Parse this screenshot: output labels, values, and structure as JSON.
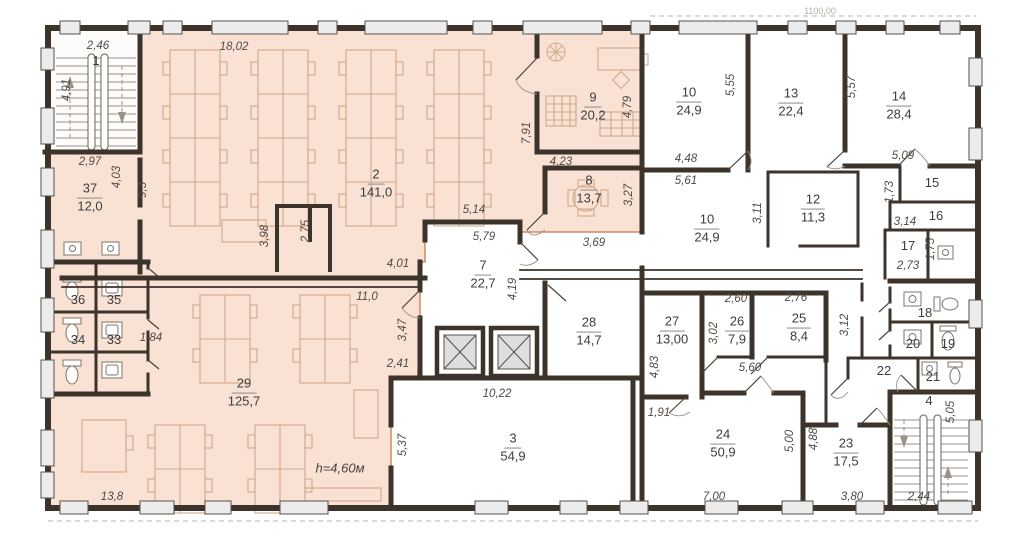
{
  "plan": {
    "scale_label": "1100,00",
    "height_label": "h=4,60м",
    "colors": {
      "highlight_fill": "#f9e2d4",
      "highlight_border": "#cf8a5f",
      "wall": "#3c332b",
      "window_pier": "#ececec",
      "furniture": "#c9a083"
    },
    "icons": {
      "stairs-icon": "tread-lines-with-arrows",
      "elevator-icon": "crossed-square",
      "toilet-icon": "oval-bowl",
      "sink-icon": "basin-square",
      "desk-cluster-icon": "rect-grid",
      "plant-icon": "spoked-circle",
      "door-icon": "leaf-and-arc"
    },
    "rooms": [
      {
        "n": "1",
        "a": null,
        "x": 96,
        "y": 62
      },
      {
        "n": "2",
        "a": "141,0",
        "x": 376,
        "y": 184
      },
      {
        "n": "3",
        "a": "54,9",
        "x": 513,
        "y": 448
      },
      {
        "n": "4",
        "a": null,
        "x": 929,
        "y": 402
      },
      {
        "n": "7",
        "a": "22,7",
        "x": 483,
        "y": 275
      },
      {
        "n": "8",
        "a": "13,7",
        "x": 589,
        "y": 190
      },
      {
        "n": "9",
        "a": "20,2",
        "x": 593,
        "y": 107
      },
      {
        "n": "10",
        "a": "24,9",
        "x": 689,
        "y": 102
      },
      {
        "n": "10",
        "a": "24,9",
        "x": 707,
        "y": 229
      },
      {
        "n": "12",
        "a": "11,3",
        "x": 813,
        "y": 209
      },
      {
        "n": "13",
        "a": "22,4",
        "x": 791,
        "y": 103
      },
      {
        "n": "14",
        "a": "28,4",
        "x": 899,
        "y": 106
      },
      {
        "n": "15",
        "a": null,
        "x": 932,
        "y": 184
      },
      {
        "n": "16",
        "a": null,
        "x": 936,
        "y": 217
      },
      {
        "n": "17",
        "a": null,
        "x": 908,
        "y": 247
      },
      {
        "n": "18",
        "a": null,
        "x": 925,
        "y": 314
      },
      {
        "n": "19",
        "a": null,
        "x": 948,
        "y": 345
      },
      {
        "n": "20",
        "a": null,
        "x": 913,
        "y": 345
      },
      {
        "n": "21",
        "a": null,
        "x": 933,
        "y": 378
      },
      {
        "n": "22",
        "a": null,
        "x": 884,
        "y": 372
      },
      {
        "n": "23",
        "a": "17,5",
        "x": 846,
        "y": 453
      },
      {
        "n": "24",
        "a": "50,9",
        "x": 723,
        "y": 444
      },
      {
        "n": "25",
        "a": "8,4",
        "x": 799,
        "y": 328
      },
      {
        "n": "26",
        "a": "7,9",
        "x": 737,
        "y": 331
      },
      {
        "n": "27",
        "a": "13,00",
        "x": 672,
        "y": 331
      },
      {
        "n": "28",
        "a": "14,7",
        "x": 589,
        "y": 332
      },
      {
        "n": "29",
        "a": "125,7",
        "x": 244,
        "y": 393
      },
      {
        "n": "33",
        "a": null,
        "x": 114,
        "y": 341
      },
      {
        "n": "34",
        "a": null,
        "x": 78,
        "y": 341
      },
      {
        "n": "35",
        "a": null,
        "x": 114,
        "y": 301
      },
      {
        "n": "36",
        "a": null,
        "x": 78,
        "y": 301
      },
      {
        "n": "37",
        "a": "12,0",
        "x": 90,
        "y": 198
      }
    ],
    "dims": [
      {
        "t": "4,91",
        "x": 67,
        "y": 90,
        "v": 1
      },
      {
        "t": "2,46",
        "x": 98,
        "y": 46,
        "v": 0
      },
      {
        "t": "18,02",
        "x": 234,
        "y": 47,
        "v": 0
      },
      {
        "t": "2,97",
        "x": 90,
        "y": 162,
        "v": 0
      },
      {
        "t": "4,03",
        "x": 117,
        "y": 177,
        "v": 1
      },
      {
        "t": "9,3",
        "x": 143,
        "y": 190,
        "v": 1
      },
      {
        "t": "7,91",
        "x": 527,
        "y": 133,
        "v": 1
      },
      {
        "t": "4,79",
        "x": 628,
        "y": 107,
        "v": 1
      },
      {
        "t": "4,23",
        "x": 561,
        "y": 162,
        "v": 0
      },
      {
        "t": "3,27",
        "x": 629,
        "y": 195,
        "v": 1
      },
      {
        "t": "3,69",
        "x": 594,
        "y": 243,
        "v": 0
      },
      {
        "t": "5,14",
        "x": 474,
        "y": 210,
        "v": 0
      },
      {
        "t": "5,79",
        "x": 484,
        "y": 237,
        "v": 0
      },
      {
        "t": "4,01",
        "x": 398,
        "y": 264,
        "v": 0
      },
      {
        "t": "4,19",
        "x": 513,
        "y": 289,
        "v": 1
      },
      {
        "t": "11,0",
        "x": 367,
        "y": 297,
        "v": 0
      },
      {
        "t": "3,98",
        "x": 265,
        "y": 236,
        "v": 1
      },
      {
        "t": "2,75",
        "x": 306,
        "y": 231,
        "v": 1
      },
      {
        "t": "1,84",
        "x": 151,
        "y": 338,
        "v": 0
      },
      {
        "t": "3,47",
        "x": 403,
        "y": 330,
        "v": 1
      },
      {
        "t": "2,41",
        "x": 398,
        "y": 364,
        "v": 0
      },
      {
        "t": "13,8",
        "x": 112,
        "y": 497,
        "v": 0
      },
      {
        "t": "5,37",
        "x": 403,
        "y": 445,
        "v": 1
      },
      {
        "t": "10,22",
        "x": 497,
        "y": 394,
        "v": 0
      },
      {
        "t": "5,55",
        "x": 731,
        "y": 85,
        "v": 1
      },
      {
        "t": "5,57",
        "x": 852,
        "y": 87,
        "v": 1
      },
      {
        "t": "4,48",
        "x": 686,
        "y": 159,
        "v": 0
      },
      {
        "t": "5,61",
        "x": 686,
        "y": 181,
        "v": 0
      },
      {
        "t": "5,09",
        "x": 903,
        "y": 156,
        "v": 0
      },
      {
        "t": "1,73",
        "x": 890,
        "y": 192,
        "v": 1
      },
      {
        "t": "3,14",
        "x": 905,
        "y": 222,
        "v": 0
      },
      {
        "t": "3,11",
        "x": 758,
        "y": 213,
        "v": 1
      },
      {
        "t": "1,75",
        "x": 931,
        "y": 249,
        "v": 1
      },
      {
        "t": "2,73",
        "x": 908,
        "y": 266,
        "v": 0
      },
      {
        "t": "2,60",
        "x": 736,
        "y": 299,
        "v": 0
      },
      {
        "t": "2,76",
        "x": 796,
        "y": 298,
        "v": 0
      },
      {
        "t": "3,02",
        "x": 714,
        "y": 333,
        "v": 1
      },
      {
        "t": "3,12",
        "x": 845,
        "y": 325,
        "v": 1
      },
      {
        "t": "5,60",
        "x": 750,
        "y": 368,
        "v": 0
      },
      {
        "t": "4,83",
        "x": 655,
        "y": 367,
        "v": 1
      },
      {
        "t": "1,91",
        "x": 659,
        "y": 413,
        "v": 0
      },
      {
        "t": "5,00",
        "x": 790,
        "y": 441,
        "v": 1
      },
      {
        "t": "4,88",
        "x": 814,
        "y": 439,
        "v": 1
      },
      {
        "t": "7,00",
        "x": 714,
        "y": 497,
        "v": 0
      },
      {
        "t": "3,80",
        "x": 852,
        "y": 497,
        "v": 0
      },
      {
        "t": "2,44",
        "x": 919,
        "y": 497,
        "v": 0
      },
      {
        "t": "5,05",
        "x": 951,
        "y": 412,
        "v": 1
      }
    ]
  }
}
